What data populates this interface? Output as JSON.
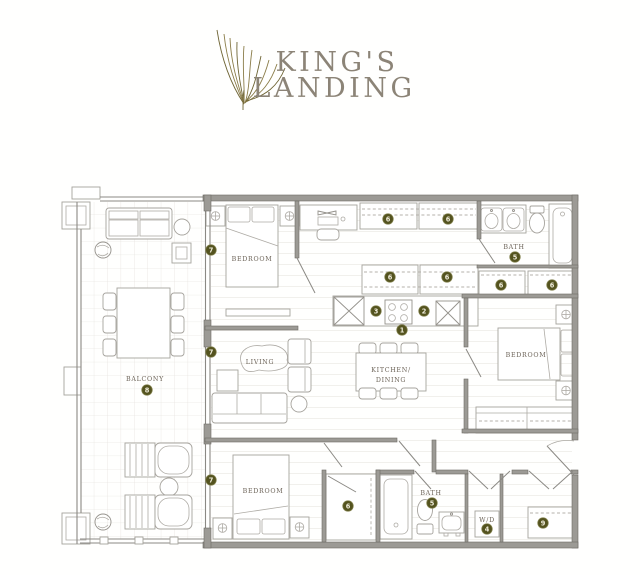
{
  "logo": {
    "title_line1": "KING'S",
    "title_line2": "LANDING"
  },
  "labels": {
    "bedroom": "BEDROOM",
    "bath": "BATH",
    "living": "LIVING",
    "kitchen_line1": "KITCHEN/",
    "kitchen_line2": "DINING",
    "balcony": "BALCONY",
    "wd": "W/D"
  },
  "markers": {
    "m1": "1",
    "m2": "2",
    "m3": "3",
    "m4": "4",
    "m5": "5",
    "m6": "6",
    "m7": "7",
    "m8": "8",
    "m9": "9"
  },
  "colors": {
    "logo_text": "#8c8477",
    "plume_gold": "#8a7c48",
    "marker_fill": "#54531f",
    "marker_text": "#f0eddc",
    "room_label": "#6d6459",
    "wall_gray": "#9c9a95"
  }
}
